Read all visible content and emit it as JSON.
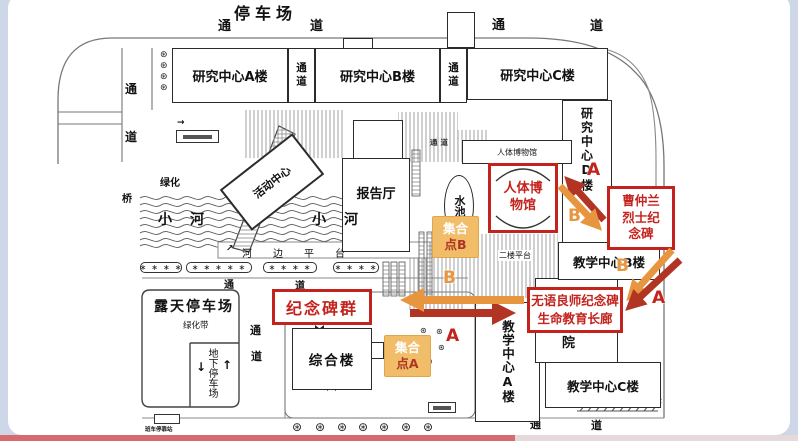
{
  "colors": {
    "red": "#c3231c",
    "arrow_red": "#b23422",
    "orange": "#e8953f",
    "assembly_bg": "#f1bd68",
    "page_bg": "#cdd7e8"
  },
  "title": {
    "parking": "停车场"
  },
  "roads": {
    "tong": "通",
    "dao": "道",
    "passage_v": "通道",
    "passage_tiny": "通道",
    "bridge": "桥"
  },
  "buildings": {
    "research_a": "研究中心A楼",
    "research_b": "研究中心B楼",
    "research_c": "研究中心C楼",
    "research_d": "研究中心D楼",
    "museum_small": "人体博物馆",
    "lecture_hall": "报告厅",
    "activity_center": "活动中心",
    "complex": "综合楼",
    "teach_a": "教学中心A楼",
    "teach_b": "教学中心B楼",
    "teach_c": "教学中心C楼",
    "yuan": "院"
  },
  "water": {
    "pool": "水池",
    "river": "小河",
    "riverside": "河边平台",
    "second_floor": "二楼平台"
  },
  "parking": {
    "open": "露天停车场",
    "green_belt": "绿化带",
    "underground": "地下停车场",
    "green": "绿化",
    "bus_stop": "班车停靠站",
    "down": "↓",
    "up": "↑",
    "ne": "↗",
    "right": "→"
  },
  "annotations": {
    "monuments": "纪念碑群",
    "museum_l1": "人体博",
    "museum_l2": "物馆",
    "cao_l1": "曹仲兰",
    "cao_l2": "烈士纪",
    "cao_l3": "念碑",
    "silent_l1": "无语良师纪念碑",
    "silent_l2": "生命教育长廊",
    "assembly_l1": "集合",
    "assembly_a_l2": "点A",
    "assembly_b_l2": "点B",
    "route_a": "A",
    "route_b": "B"
  },
  "icons": {
    "tree": "⊛",
    "shrub4": "∗∗∗∗",
    "shrub5": "∗∗∗∗∗",
    "cross": "✕"
  }
}
